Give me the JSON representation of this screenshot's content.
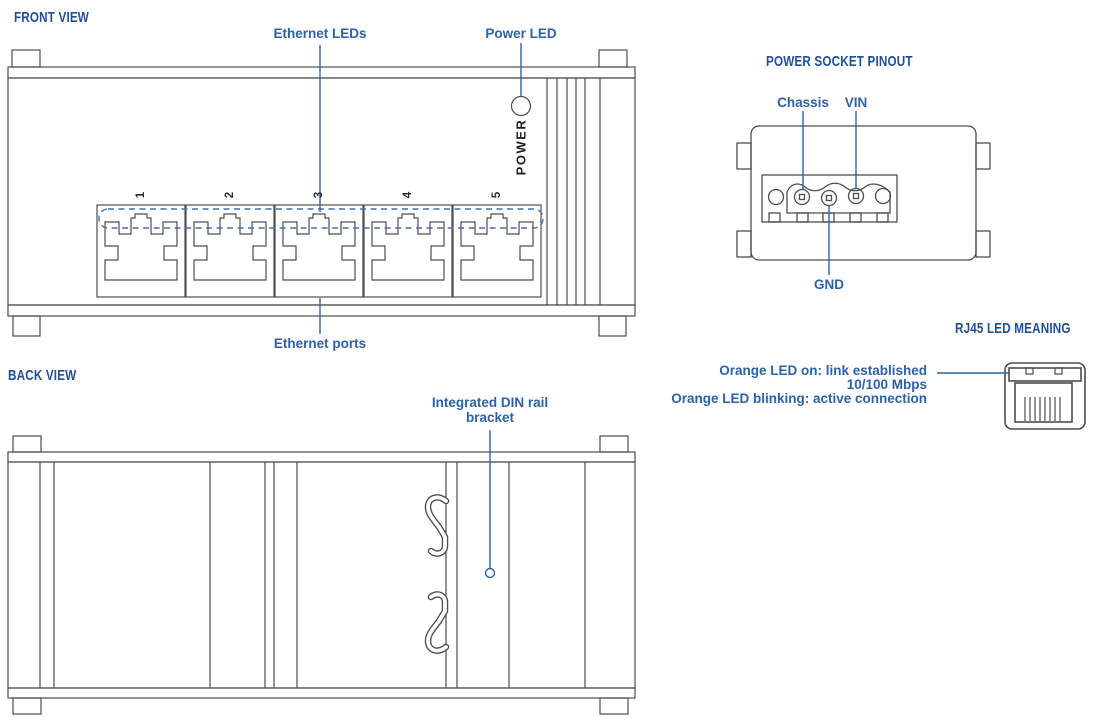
{
  "front_view": {
    "title": "FRONT VIEW",
    "labels": {
      "ethernet_leds": "Ethernet LEDs",
      "power_led": "Power LED",
      "ethernet_ports": "Ethernet ports",
      "power_silkscreen": "POWER"
    },
    "port_numbers": [
      "1",
      "2",
      "3",
      "4",
      "5"
    ]
  },
  "back_view": {
    "title": "BACK VIEW",
    "labels": {
      "din_bracket": "Integrated DIN rail bracket"
    }
  },
  "power_socket": {
    "title": "POWER SOCKET PINOUT",
    "pins": {
      "chassis": "Chassis",
      "vin": "VIN",
      "gnd": "GND"
    }
  },
  "rj45": {
    "title": "RJ45 LED MEANING",
    "lines": [
      "Orange LED on: link established",
      "10/100 Mbps",
      "Orange LED blinking: active connection"
    ]
  },
  "colors": {
    "header_blue": "#1e4f9e",
    "label_blue": "#2b61ad",
    "leader_blue": "#2e64a8",
    "dashed_blue": "#4170b3",
    "line_gray": "#4d4d50"
  }
}
